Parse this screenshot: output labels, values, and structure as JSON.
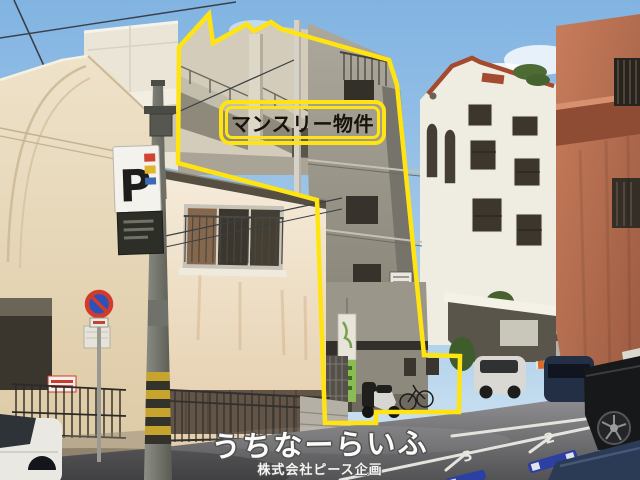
{
  "overlay": {
    "property_label": "マンスリー物件"
  },
  "watermark": {
    "site_name": "うちなーらいふ",
    "company": "株式会社ピース企画"
  },
  "street": {
    "parking_sign_label": "P",
    "space_numbers": [
      "3",
      "2"
    ]
  },
  "colors": {
    "outline_yellow": "#ffe412",
    "sky_top": "#82b4e2",
    "sky_horizon": "#d8e8f3",
    "concrete_gray": "#a5a195",
    "house_cream": "#efdcc1",
    "terracotta": "#c0775a",
    "wheel_stop_blue": "#2c3fa3"
  }
}
